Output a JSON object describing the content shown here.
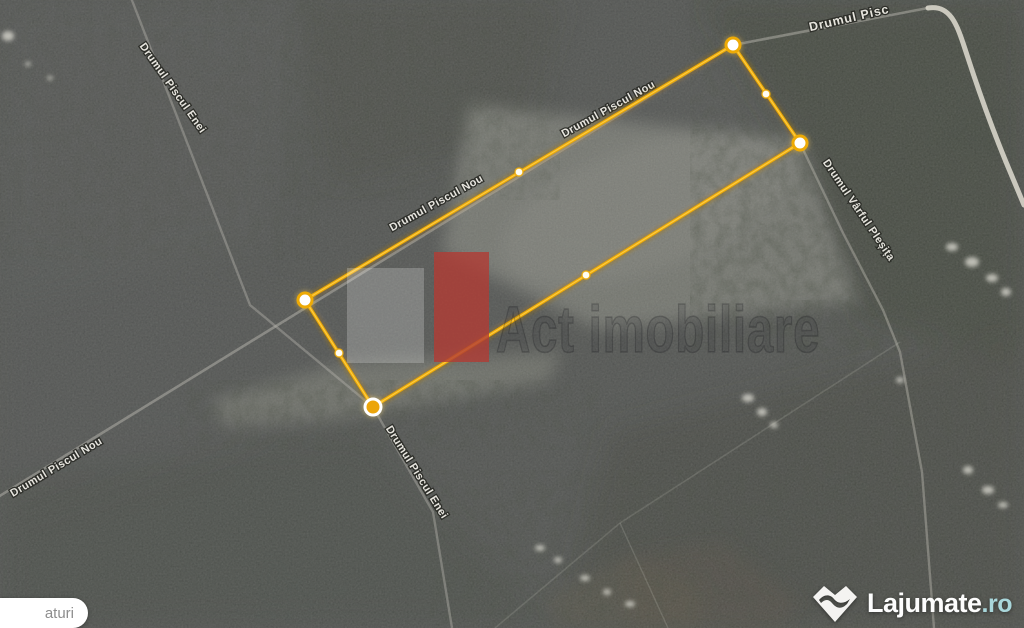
{
  "map": {
    "road_labels": [
      {
        "text": "Drumul Pisc"
      },
      {
        "text": "Drumul Piscul Nou"
      },
      {
        "text": "Drumul Piscul Nou"
      },
      {
        "text": "Drumul Piscul Nou"
      },
      {
        "text": "Drumul Piscul Enei"
      },
      {
        "text": "Drumul Piscul Enei"
      },
      {
        "text": "Drumul Vârful Pleșița"
      }
    ],
    "parcel": {
      "points": "305,300 733,45 800,143 373,407",
      "stroke_color": "#edaa06",
      "vertex_fill": "#ffffff",
      "selected_vertex_fill": "#eca50a"
    },
    "watermark": {
      "text": "Act imobiliare",
      "red_block_color": "#b23c34"
    }
  },
  "controls": {
    "layers_button_label": "aturi"
  },
  "branding": {
    "logo_main": "Lajumate",
    "logo_tld": ".ro",
    "tld_color": "#a9d6da"
  }
}
